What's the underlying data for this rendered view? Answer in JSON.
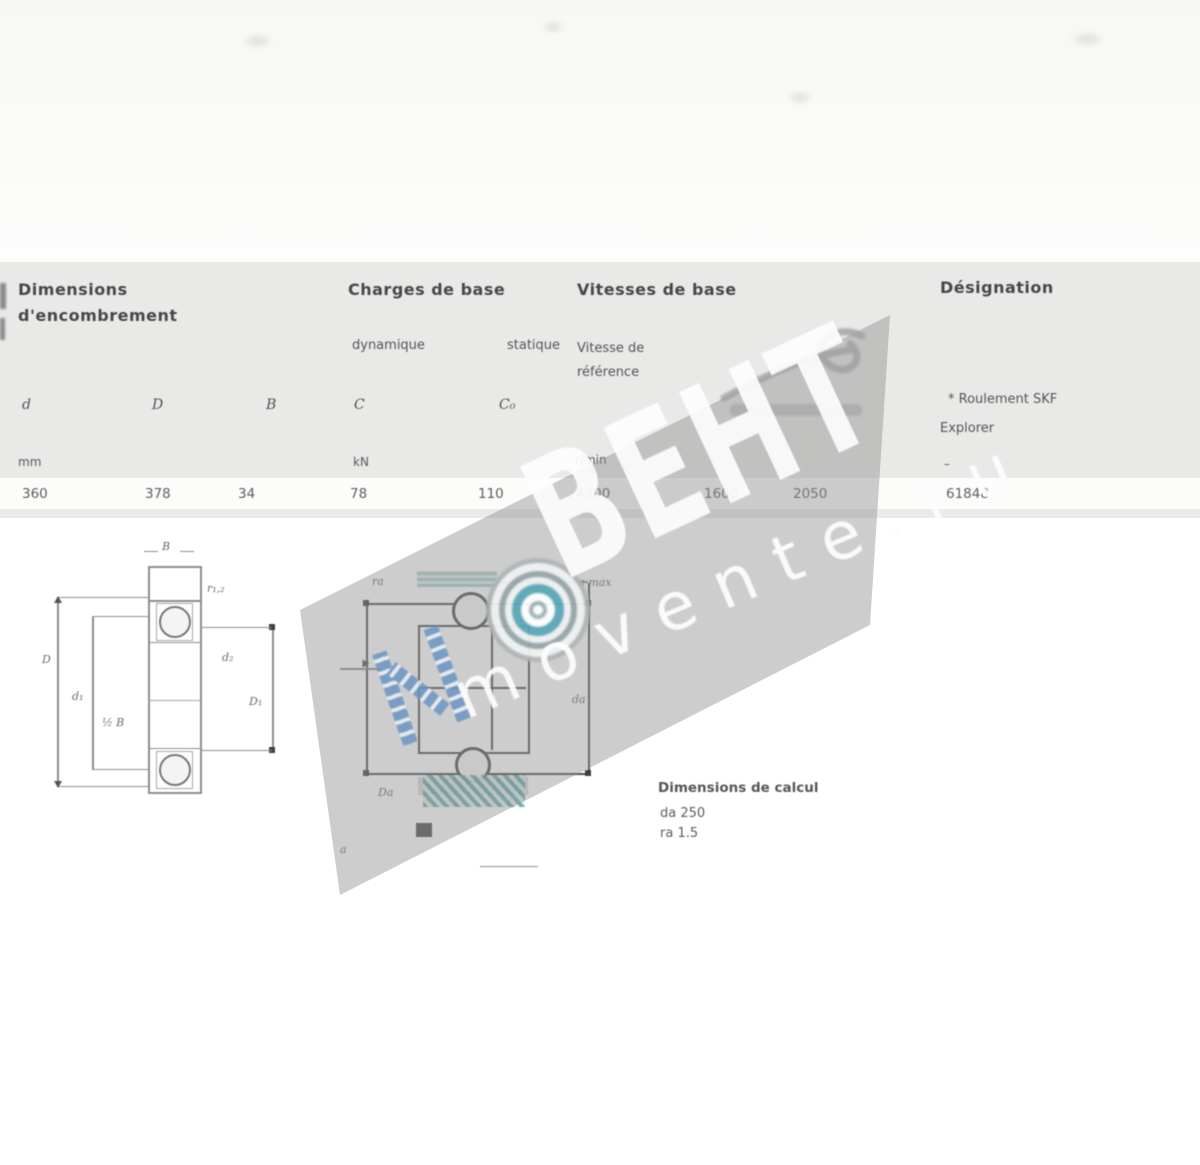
{
  "page": {
    "background": "#ffffff",
    "table_background": "#e9e9e8",
    "watermark_band_color": "rgba(145,145,145,0.45)",
    "accent_teal": "#4e9aa8",
    "accent_blue": "#6b95c2"
  },
  "table": {
    "group_dimensions": {
      "line1": "Dimensions",
      "line2": "d'encombrement"
    },
    "group_charges": {
      "title": "Charges de base",
      "sub_dynamique": "dynamique",
      "sub_statique": "statique"
    },
    "group_vitesses": {
      "title": "Vitesses de base",
      "sub_line1": "Vitesse de",
      "sub_line2": "référence"
    },
    "group_designation": {
      "title": "Désignation",
      "note_line1": "* Roulement SKF",
      "note_line2": "Explorer"
    },
    "symbols": [
      "d",
      "D",
      "B",
      "C",
      "C₀"
    ],
    "units": [
      "mm",
      "kN",
      "r/min",
      "–"
    ],
    "row": [
      "360",
      "378",
      "34",
      "78",
      "110",
      "4300",
      "1600",
      "2050",
      "61848"
    ]
  },
  "left_drawing": {
    "labels": {
      "b": "B",
      "r12": "r₁,₂",
      "D": "D",
      "d1": "d₁",
      "half_b": "½ B",
      "d2": "d₂",
      "D1": "D₁"
    }
  },
  "right_drawing": {
    "labels": {
      "ra_left": "ra",
      "ra_max": "ra max",
      "da_right": "da",
      "da_bottom": "Da",
      "a": "a"
    }
  },
  "calc_block": {
    "heading": "Dimensions de calcul",
    "line1": "da  250",
    "line2": "ra  1.5"
  },
  "watermark": {
    "main": "ВЕНТ",
    "sub": "movente.ru"
  }
}
